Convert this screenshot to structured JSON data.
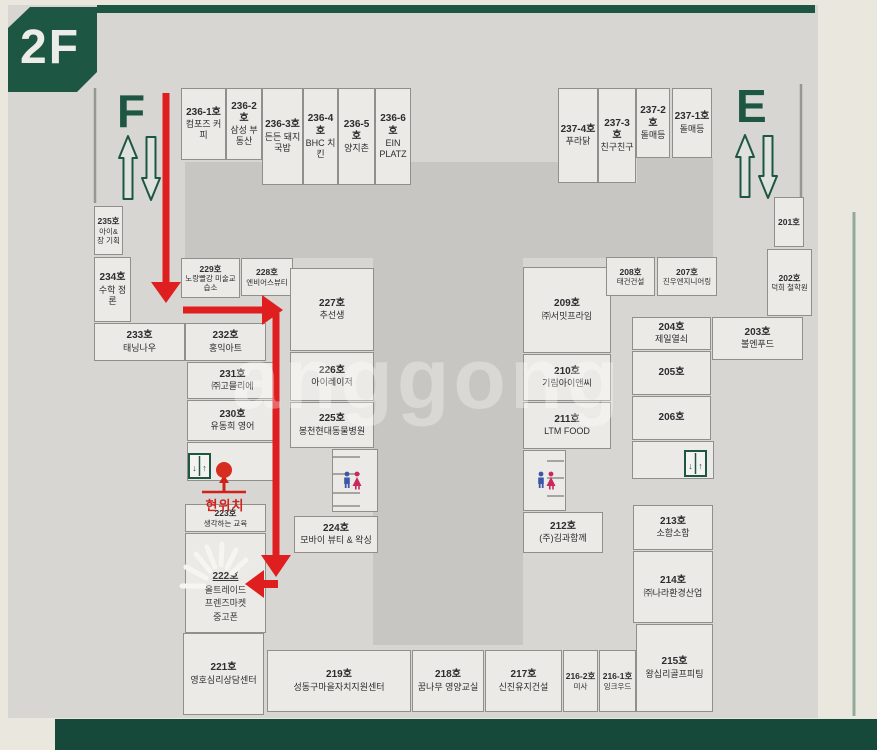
{
  "floor_label": "2F",
  "wing_f": "F",
  "wing_e": "E",
  "marker": {
    "label": "현위치"
  },
  "watermark": {
    "text": "anggong"
  },
  "elevator": {
    "down_glyph": "↓",
    "up_glyph": "↑"
  },
  "icons": {
    "elevator": "elevator-doors-icon",
    "restroom": "restroom-mf-icon",
    "escalator_up": "escalator-up-arrow-icon",
    "escalator_down": "escalator-down-arrow-icon",
    "current_location": "current-location-dot",
    "destination_highlight": "starburst"
  },
  "colors": {
    "board_green": "#1d5743",
    "path_red": "#df1f1f",
    "male_blue": "#3a57a8",
    "female_pink": "#c7295e",
    "board_gray": "#d7d6d2",
    "courtyard_gray": "#c7c6c2"
  },
  "rooms": {
    "u236_1": {
      "no": "236-1호",
      "name": "컴포즈 커피"
    },
    "u236_2": {
      "no": "236-2호",
      "name": "삼성 부동산"
    },
    "u236_3": {
      "no": "236-3호",
      "name": "든든 돼지국밥"
    },
    "u236_4": {
      "no": "236-4호",
      "name": "BHC 치킨"
    },
    "u236_5": {
      "no": "236-5호",
      "name": "양지촌"
    },
    "u236_6": {
      "no": "236-6호",
      "name": "EIN PLATZ"
    },
    "u237_4": {
      "no": "237-4호",
      "name": "푸라닭"
    },
    "u237_3": {
      "no": "237-3호",
      "name": "친구친구"
    },
    "u237_2": {
      "no": "237-2호",
      "name": "돌매등"
    },
    "u237_1": {
      "no": "237-1호",
      "name": "돌매등"
    },
    "u235": {
      "no": "235호",
      "name": "아이&장 기획"
    },
    "u234": {
      "no": "234호",
      "name": "수학 정론"
    },
    "u233": {
      "no": "233호",
      "name": "태닝나우"
    },
    "u232": {
      "no": "232호",
      "name": "홍익아트"
    },
    "u231": {
      "no": "231호",
      "name": "㈜고믈리에"
    },
    "u230": {
      "no": "230호",
      "name": "유동희 영어"
    },
    "u229": {
      "no": "229호",
      "name": "노랑빨강 미술교습소"
    },
    "u228": {
      "no": "228호",
      "name": "엔비어스뷰티"
    },
    "u227": {
      "no": "227호",
      "name": "추선생"
    },
    "u226": {
      "no": "226호",
      "name": "아이레이저"
    },
    "u225": {
      "no": "225호",
      "name": "봉천현대동물병원"
    },
    "u224": {
      "no": "224호",
      "name": "모바이 뷰티 & 왁싱"
    },
    "u223": {
      "no": "223호",
      "name": "생각하는 교육"
    },
    "u222": {
      "no": "222호",
      "l1": "올트레이드",
      "l2": "프렌즈마켓",
      "l3": "중고폰"
    },
    "u221": {
      "no": "221호",
      "name": "영호심리상담센터"
    },
    "u219": {
      "no": "219호",
      "name": "성동구마을자치지원센터"
    },
    "u218": {
      "no": "218호",
      "name": "꿈나무 영양교실"
    },
    "u217": {
      "no": "217호",
      "name": "신진유지건설"
    },
    "u216_2": {
      "no": "216-2호",
      "name": "미사"
    },
    "u216_1": {
      "no": "216-1호",
      "name": "잉크우드"
    },
    "u215": {
      "no": "215호",
      "name": "왕십리골프피팅"
    },
    "u214": {
      "no": "214호",
      "name": "㈜나라환경산업"
    },
    "u213": {
      "no": "213호",
      "name": "소함소함"
    },
    "u212": {
      "no": "212호",
      "name": "(주)김과함께"
    },
    "u211": {
      "no": "211호",
      "name": "LTM FOOD"
    },
    "u210": {
      "no": "210호",
      "name": "기림아이앤씨"
    },
    "u209": {
      "no": "209호",
      "name": "㈜서밋프라임"
    },
    "u208": {
      "no": "208호",
      "name": "태건건설"
    },
    "u207": {
      "no": "207호",
      "name": "진우엔지니어링"
    },
    "u206": {
      "no": "206호",
      "name": ""
    },
    "u205": {
      "no": "205호",
      "name": ""
    },
    "u204": {
      "no": "204호",
      "name": "제일열쇠"
    },
    "u203": {
      "no": "203호",
      "name": "볼엔푸드"
    },
    "u202": {
      "no": "202호",
      "name": "덕희 철학원"
    },
    "u201": {
      "no": "201호",
      "name": ""
    }
  }
}
